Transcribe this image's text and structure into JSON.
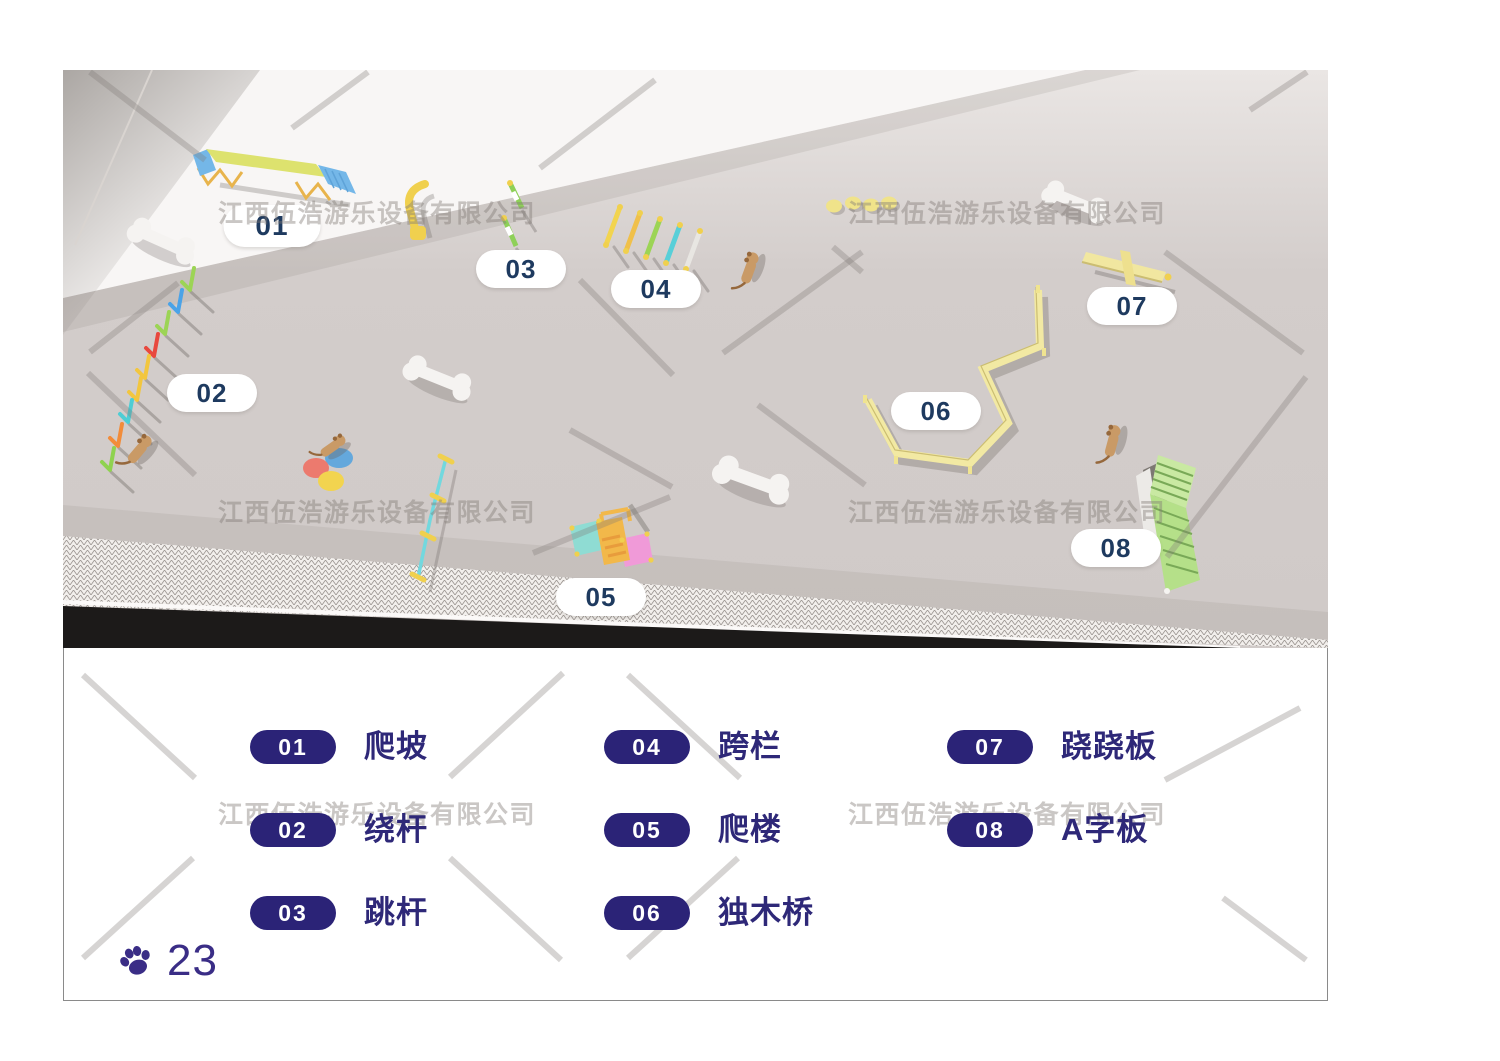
{
  "watermark": {
    "text": "江西伍浩游乐设备有限公司",
    "color": "#b5afab"
  },
  "scene": {
    "description": "3D top-view render of dog agility park",
    "callouts": [
      "01",
      "02",
      "03",
      "04",
      "05",
      "06",
      "07",
      "08"
    ]
  },
  "legend": {
    "badge_color": "#2b2377",
    "label_color": "#2e2878",
    "items": [
      {
        "num": "01",
        "label": "爬坡"
      },
      {
        "num": "02",
        "label": "绕杆"
      },
      {
        "num": "03",
        "label": "跳杆"
      },
      {
        "num": "04",
        "label": "跨栏"
      },
      {
        "num": "05",
        "label": "爬楼"
      },
      {
        "num": "06",
        "label": "独木桥"
      },
      {
        "num": "07",
        "label": "跷跷板"
      },
      {
        "num": "08",
        "label": "A字板"
      }
    ]
  },
  "footer": {
    "page_number": "23"
  },
  "colors": {
    "callout_text": "#1e3a5f",
    "page_number": "#3a2d86",
    "floor": "#d2cccb",
    "equip_yellow": "#f0e490",
    "equip_green": "#b5e089",
    "equip_blue": "#74b7e8"
  }
}
